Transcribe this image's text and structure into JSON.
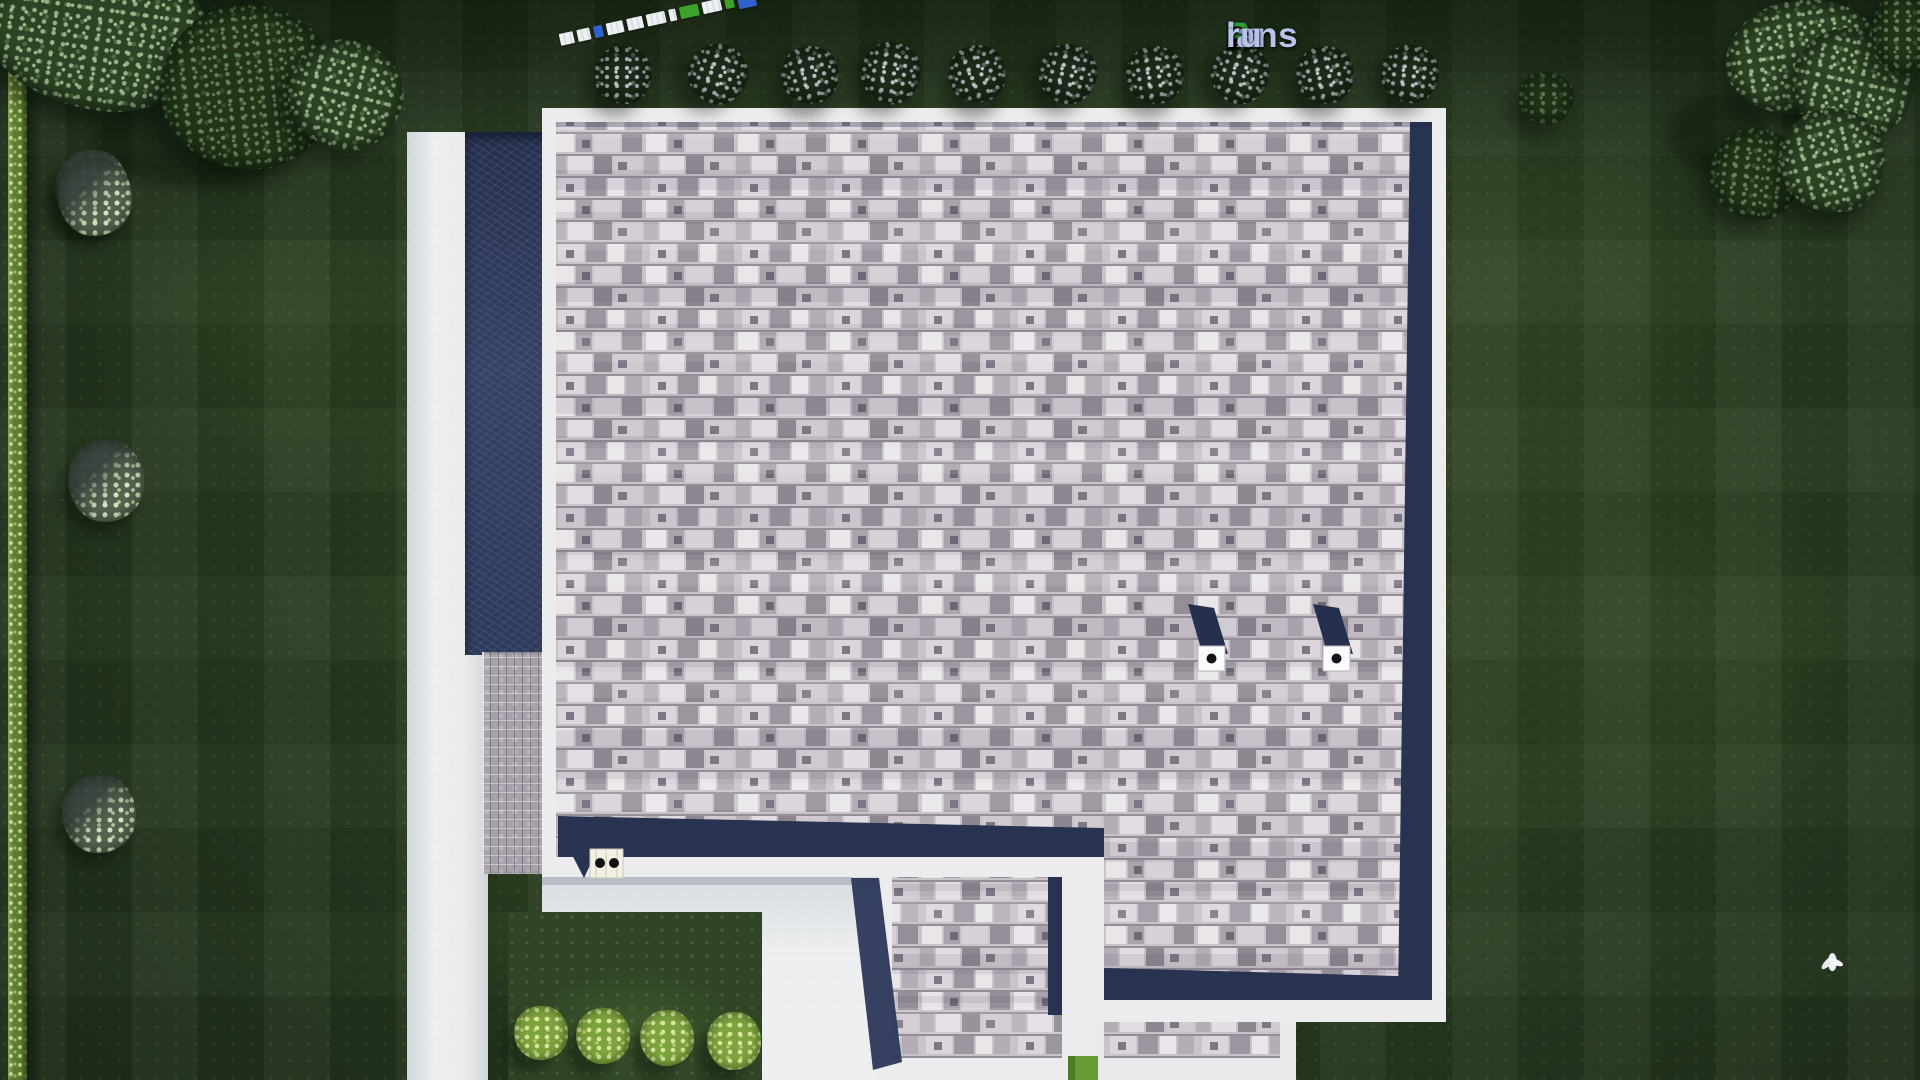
{
  "watermark": {
    "parts": [
      {
        "text": "F",
        "color": "#4a74d8"
      },
      {
        "text": "ix",
        "color": "#b9c3ea"
      },
      {
        "text": "P",
        "color": "#2f9e30"
      },
      {
        "text": "lans",
        "color": "#b9c3ea"
      },
      {
        "text": ".",
        "color": "#f2f5fb"
      },
      {
        "text": "ru",
        "color": "#b9c3ea"
      }
    ],
    "full_text": "FixPlans.ru"
  },
  "scale_bar": {
    "segment_colors": [
      "white",
      "white",
      "blue",
      "white",
      "white",
      "white",
      "white",
      "green",
      "white",
      "green",
      "blue"
    ],
    "blue": "#2e62c8",
    "green": "#3ba32a",
    "white": "#eef1f4"
  },
  "palette": {
    "lawn_green": "#2c4023",
    "hedge_green": "#9db85c",
    "concrete": "#e7e9ea",
    "roof_shingle_base": "#c9c3c9",
    "roof_fascia_white": "#ececee",
    "roof_edge_navy": "#273350",
    "side_wall_navy": "#2d3a59",
    "grass_sliver_green": "#679a33"
  },
  "scene": {
    "objects": [
      "flat-shingle-roof",
      "roof-extension",
      "roof-vent",
      "roof-vent",
      "roof-chimney-cap",
      "white-fascia-border",
      "navy-edge-shadow",
      "driveway",
      "patio",
      "paver-strip",
      "hedge-row",
      "tree-row-top",
      "tree-cluster-top-left",
      "tree-cluster-top-right",
      "ornamental-bush",
      "lime-bush-row",
      "flying-bird",
      "flying-bird",
      "scale-bar",
      "watermark-logo"
    ],
    "tree_row_count": 10,
    "lime_bush_count": 4,
    "roof_vent_count": 2,
    "bird_count": 2
  }
}
